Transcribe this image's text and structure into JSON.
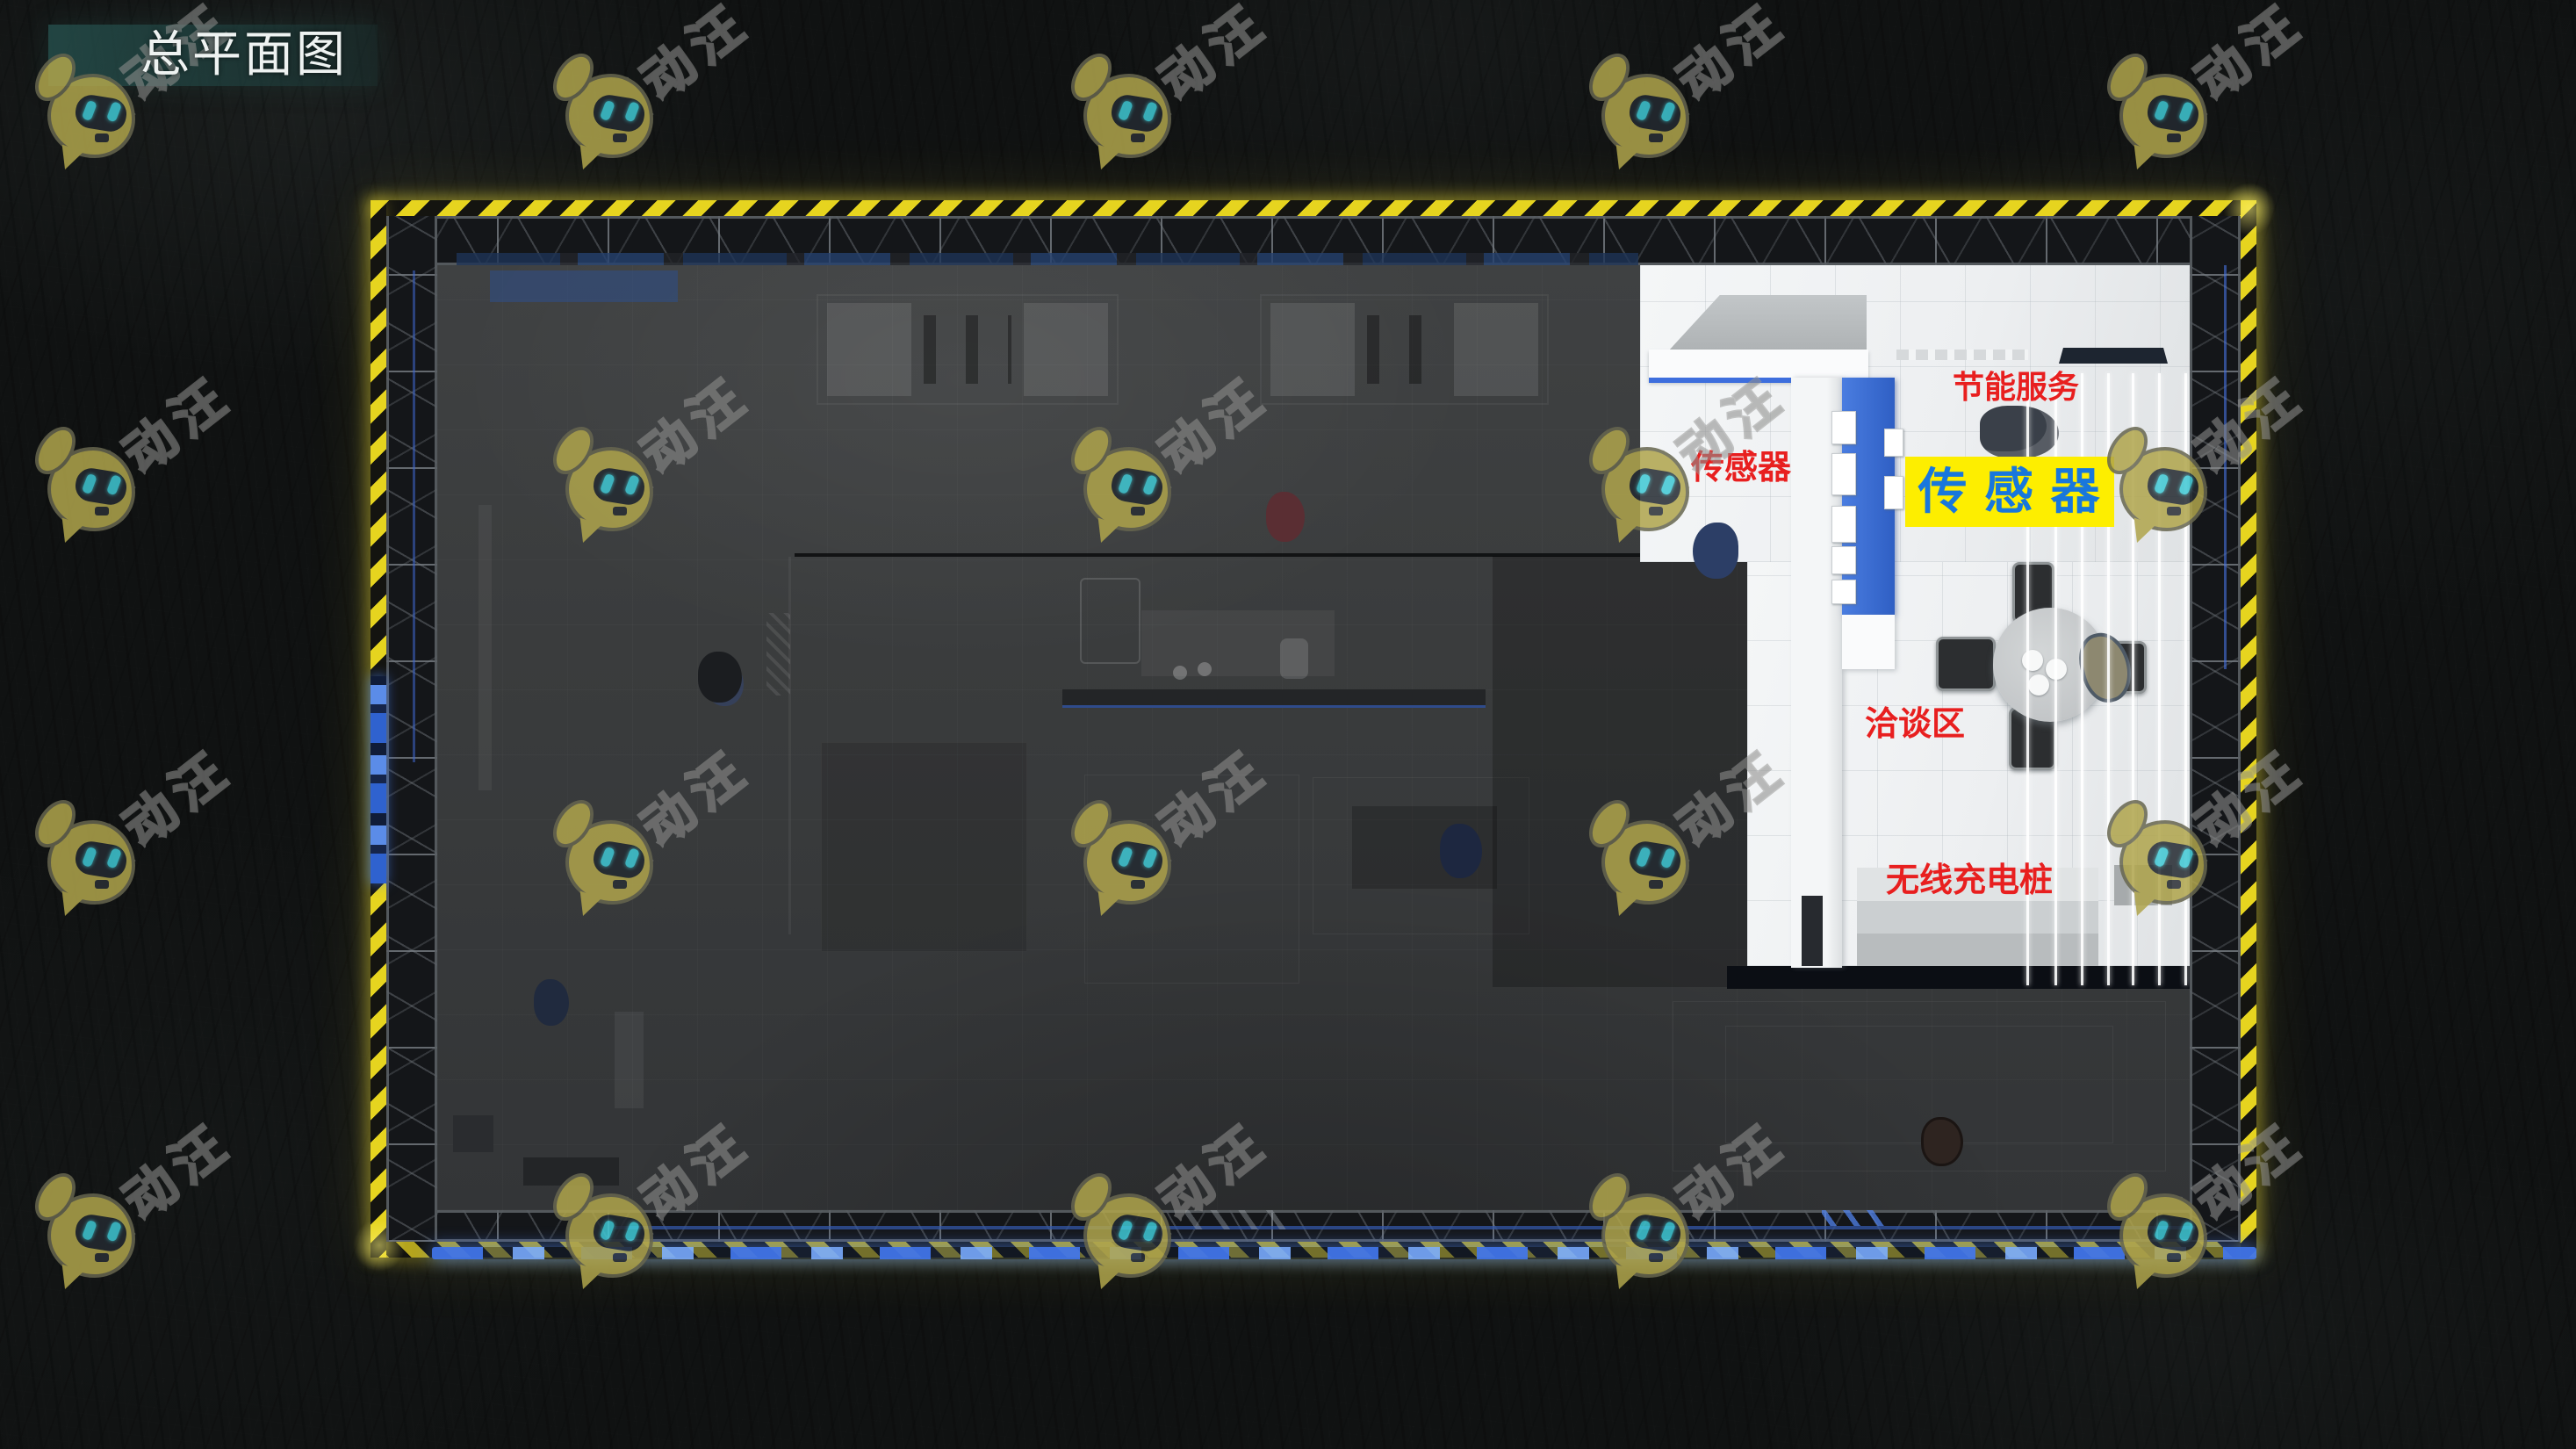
{
  "header": {
    "title": "总平面图",
    "banner_color": "#26524f"
  },
  "watermark": {
    "text": "活动汪",
    "mascot": "robot-dog-icon"
  },
  "plan": {
    "name": "展位总平面图渲染图",
    "labels": {
      "energy_service": {
        "text": "节能服务",
        "color": "#e81f1f"
      },
      "sensor_small": {
        "text": "传感器",
        "color": "#e81f1f"
      },
      "sensor_big": {
        "text": "传 感 器",
        "text_color": "#1877dc",
        "bg_color": "#fdee00"
      },
      "negotiation": {
        "text": "洽谈区",
        "color": "#e81f1f"
      },
      "wireless_charging": {
        "text": "无线充电桩",
        "color": "#e81f1f"
      }
    },
    "colors": {
      "caution_yellow": "#e6d41f",
      "led_blue": "#4074e8",
      "display_blue": "#3f70d4",
      "highlight_floor": "#eef0f1",
      "dim_floor": "#3a3c3d"
    }
  }
}
